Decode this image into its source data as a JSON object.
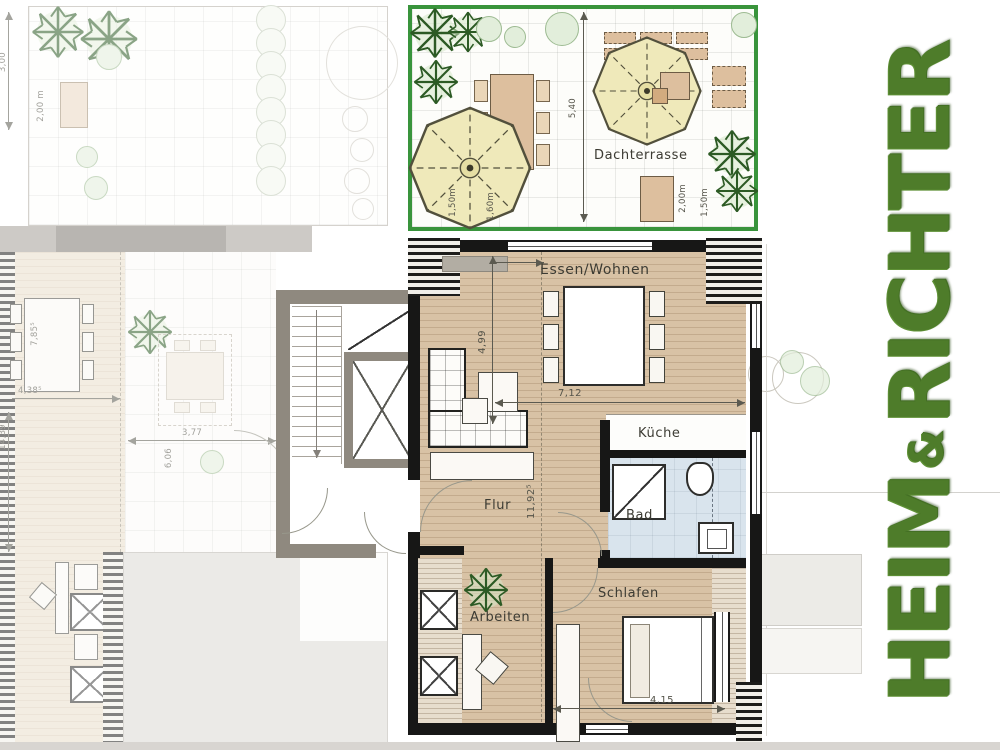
{
  "brand": {
    "heim": "HEIM",
    "amp": "&",
    "richter": "RICHTER",
    "color": "#4e7c2a"
  },
  "terrace": {
    "label": "Dachterrasse",
    "border_color": "#39943c",
    "dim_depth": "5,40",
    "dim_parasol_width": "1,50m",
    "dim_parasol_height": "1,60m",
    "dim_planter_a": "2,00m",
    "dim_planter_b": "1,50m"
  },
  "apartment": {
    "room_living": "Essen/Wohnen",
    "room_kitchen": "Küche",
    "room_bath": "Bad",
    "room_hall": "Flur",
    "room_office": "Arbeiten",
    "room_bedroom": "Schlafen",
    "dim_living_width": "7,12",
    "dim_living_depth": "4,99",
    "dim_hall_length": "11,92⁵",
    "dim_bedroom_width": "4,15"
  },
  "context": {
    "dim_terrace_depth": "3,00",
    "dim_planter": "2,00 m",
    "dim_room_depth": "7,85⁵",
    "dim_room_width": "4,38⁵",
    "dim_total_depth": "14,39",
    "dim_mid_width": "3,77",
    "dim_mid_depth": "6,06"
  }
}
